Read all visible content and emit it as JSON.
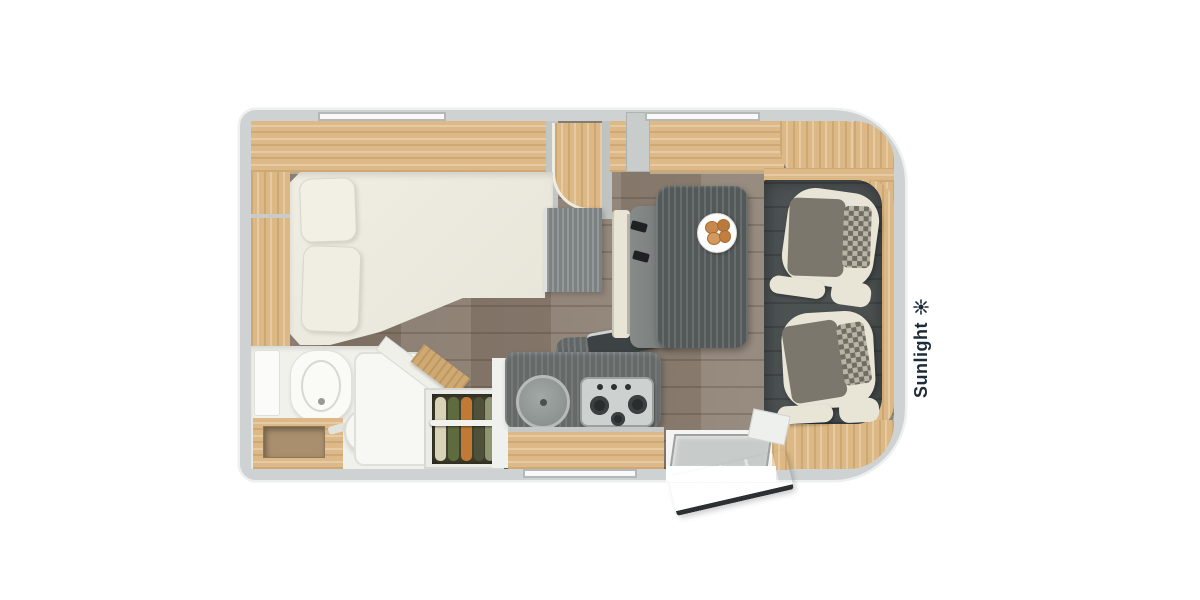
{
  "brand": {
    "logo_text": "Sunlight",
    "logo_icon": "sun-burst-icon",
    "logo_color": "#1e2c3a"
  },
  "palette": {
    "wall_gray": "#ced2d2",
    "cabinet_wood": "#ddb987",
    "floor_plank": "#8a7c6e",
    "counter_dark": "#6d7271",
    "cab_floor_dark": "#4c5152",
    "upholstery_cream": "#e8e5d7",
    "upholstery_gray": "#7b776d",
    "windshield_dark": "#2d3437",
    "mirror_black": "#17191b",
    "croissant": "#c8894e",
    "clothes": [
      "#d8d2b6",
      "#5e6b3f",
      "#c17a35",
      "#4f5138",
      "#8f9571"
    ]
  },
  "floorplan": {
    "vehicle_type": "motorhome-top-view",
    "features": [
      "overhead-cabinets",
      "rear-french-bed",
      "pillows",
      "side-shelf",
      "bathroom",
      "toilet",
      "swivel-washbasin",
      "vanity-counter",
      "shower-tray",
      "clothes-wardrobe",
      "hanging-rail",
      "kitchen-counter",
      "round-sink",
      "gas-hob-3-burner",
      "kitchen-drawer",
      "dinette-bench",
      "seat-belts",
      "dining-table",
      "breakfast-plate",
      "entry-door-open",
      "entry-step",
      "cab-floor",
      "driver-seat-swiveled",
      "passenger-seat-swiveled",
      "windshield",
      "wipers",
      "side-mirror-top",
      "side-mirror-bottom",
      "window-top-left",
      "window-top-right",
      "window-bottom"
    ]
  }
}
